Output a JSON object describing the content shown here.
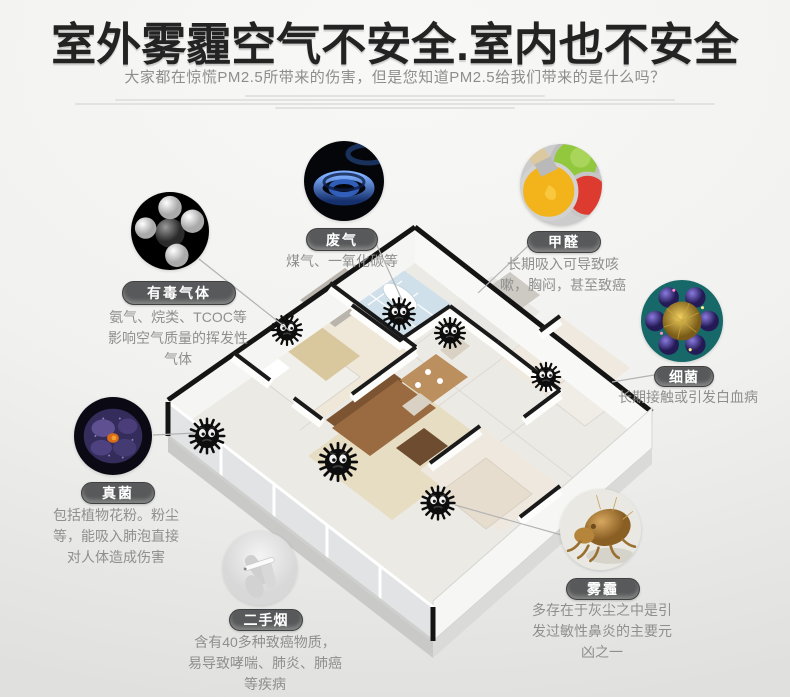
{
  "page": {
    "title": "室外雾霾空气不安全.室内也不安全",
    "subtitle": "大家都在惊慌PM2.5所带来的伤害，但是您知道PM2.5给我们带来的是什么吗？"
  },
  "colors": {
    "title_text": "#232323",
    "subtitle_text": "#8d8d8d",
    "pill_background": "#58595a",
    "pill_text": "#ffffff",
    "description_text": "#8f8f8f",
    "connector_line": "#b3b3b3"
  },
  "callouts": [
    {
      "id": "toxic-gas",
      "label": "有毒气体",
      "description": "氨气、烷类、TCOC等影响空气质量的挥发性气体",
      "image": "molecule-photo"
    },
    {
      "id": "exhaust-gas",
      "label": "废气",
      "description": "煤气、一氧化碳等",
      "image": "gas-flame-photo"
    },
    {
      "id": "formaldehyde",
      "label": "甲醛",
      "description": "长期吸入可导致咳嗽，胸闷，甚至致癌",
      "image": "paint-cans-photo"
    },
    {
      "id": "bacteria",
      "label": "细菌",
      "description": "长期接触或引发白血病",
      "image": "virus-photo"
    },
    {
      "id": "fungus",
      "label": "真菌",
      "description": "包括植物花粉。粉尘等，能吸入肺泡直接对人体造成伤害",
      "image": "spore-photo"
    },
    {
      "id": "secondhand-smoke",
      "label": "二手烟",
      "description": "含有40多种致癌物质，易导致哮喘、肺炎、肺癌等疾病",
      "image": "cigarette-hand-photo"
    },
    {
      "id": "smog",
      "label": "雾霾",
      "description": "多存在于灰尘之中是引发过敏性鼻炎的主要元凶之一",
      "image": "dust-mite-photo"
    }
  ],
  "illustration": {
    "name": "isometric-apartment-floorplan",
    "dust_sprite_count": 7
  }
}
